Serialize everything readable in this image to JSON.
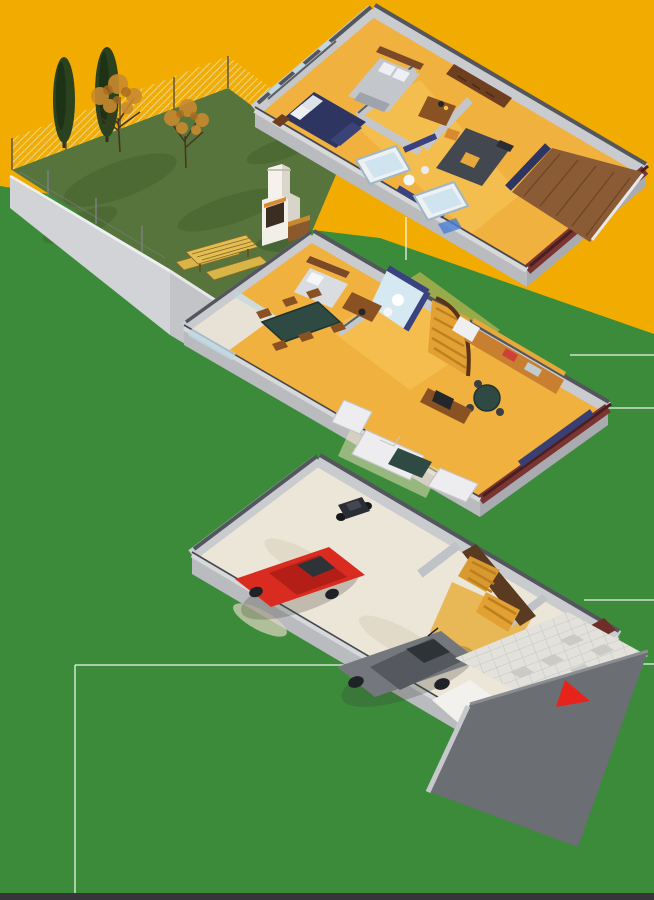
{
  "meta": {
    "kind": "isometric-cutaway-house-illustration",
    "description": "Three-level axonometric cutaway of a row house: upper floor with bedrooms and bathrooms, main floor with living room, dining, kitchen and stairs, and a garage level with two cars; fenced garden with trees at top left; red triangle entrance marker at lower right."
  },
  "palette": {
    "bg_orange": "#F2AB00",
    "bg_green": "#3B8B3B",
    "lawn": "#56743C",
    "lawn_shade": "#49652F",
    "fence": "#EDD98C",
    "cypress": "#2B421F",
    "canopy": "#C98A2E",
    "canopy2": "#A86B20",
    "trunk": "#4A3420",
    "wall_light": "#C9CBCE",
    "wall_cut": "#D6D8DA",
    "wall_top": "#53565C",
    "slab": "#B9BBBF",
    "slab2": "#A9ABB0",
    "floor_yellow": "#F0B13F",
    "hall_light": "#F7C95C",
    "terrace_wood": "#8A5B34",
    "wood": "#8A5222",
    "wood_dark": "#6E3F1E",
    "stair_wood": "#D89A2F",
    "stair_wood2": "#BE7F1F",
    "bath_navy": "#3A4380",
    "navy": "#2E3560",
    "glass_blue": "#BFD8E2",
    "maroon": "#7A3432",
    "white_soft": "#EDEFF2",
    "bed_gray": "#C3C6CB",
    "bed_dark": "#43474F",
    "table_green": "#2F4A42",
    "garage_floor": "#ECE6D9",
    "tile": "#E3E1DC",
    "tile_dark": "#CACAC6",
    "driveway": "#6B6E73",
    "red_car": "#D92B20",
    "red_car_roof": "#B31F16",
    "gray_car": "#74777C",
    "gray_car_roof": "#55585E",
    "vehicle_glass": "#2E3338",
    "marker_red": "#E8231C",
    "leader_line": "#FFFFFF",
    "footer_strip": "#36363A"
  },
  "scene": {
    "garden": {
      "name": "garden",
      "features": [
        "lawn",
        "chain-link-fence",
        "retaining-wall",
        "cypress-trees",
        "autumn-trees",
        "picnic-table",
        "barbecue"
      ],
      "cypress_count": 2,
      "autumn_tree_count": 2
    },
    "levels": [
      {
        "id": "upper-floor",
        "label": "upper floor",
        "rooms": [
          "bedroom-left",
          "bedroom-back",
          "bathroom-1",
          "bathroom-2",
          "bedroom-study",
          "terrace"
        ],
        "furniture": [
          "navy-double-bed",
          "gray-double-bed",
          "bathtub",
          "bathtub",
          "desk",
          "wardrobe",
          "dark-bed",
          "terrace-deck"
        ]
      },
      {
        "id": "main-floor",
        "label": "main floor",
        "rooms": [
          "garden-terrace",
          "study-room",
          "dining-area",
          "bathroom",
          "staircase",
          "kitchen",
          "living-room"
        ],
        "furniture": [
          "single-bed",
          "desk",
          "dining-table",
          "curved-stairs",
          "kitchen-counter",
          "fridge",
          "round-table",
          "sofa",
          "armchair",
          "coffee-table",
          "tv-sideboard"
        ]
      },
      {
        "id": "garage-level",
        "label": "garage level",
        "rooms": [
          "garage",
          "stair-hall",
          "storage",
          "entry-path",
          "driveway"
        ],
        "vehicles": [
          "red-hatchback",
          "gray-sedan",
          "motorcycle"
        ],
        "marker": "red-triangle"
      }
    ],
    "leader_lines": {
      "count": 7,
      "style": "thin white section lines on background"
    }
  }
}
